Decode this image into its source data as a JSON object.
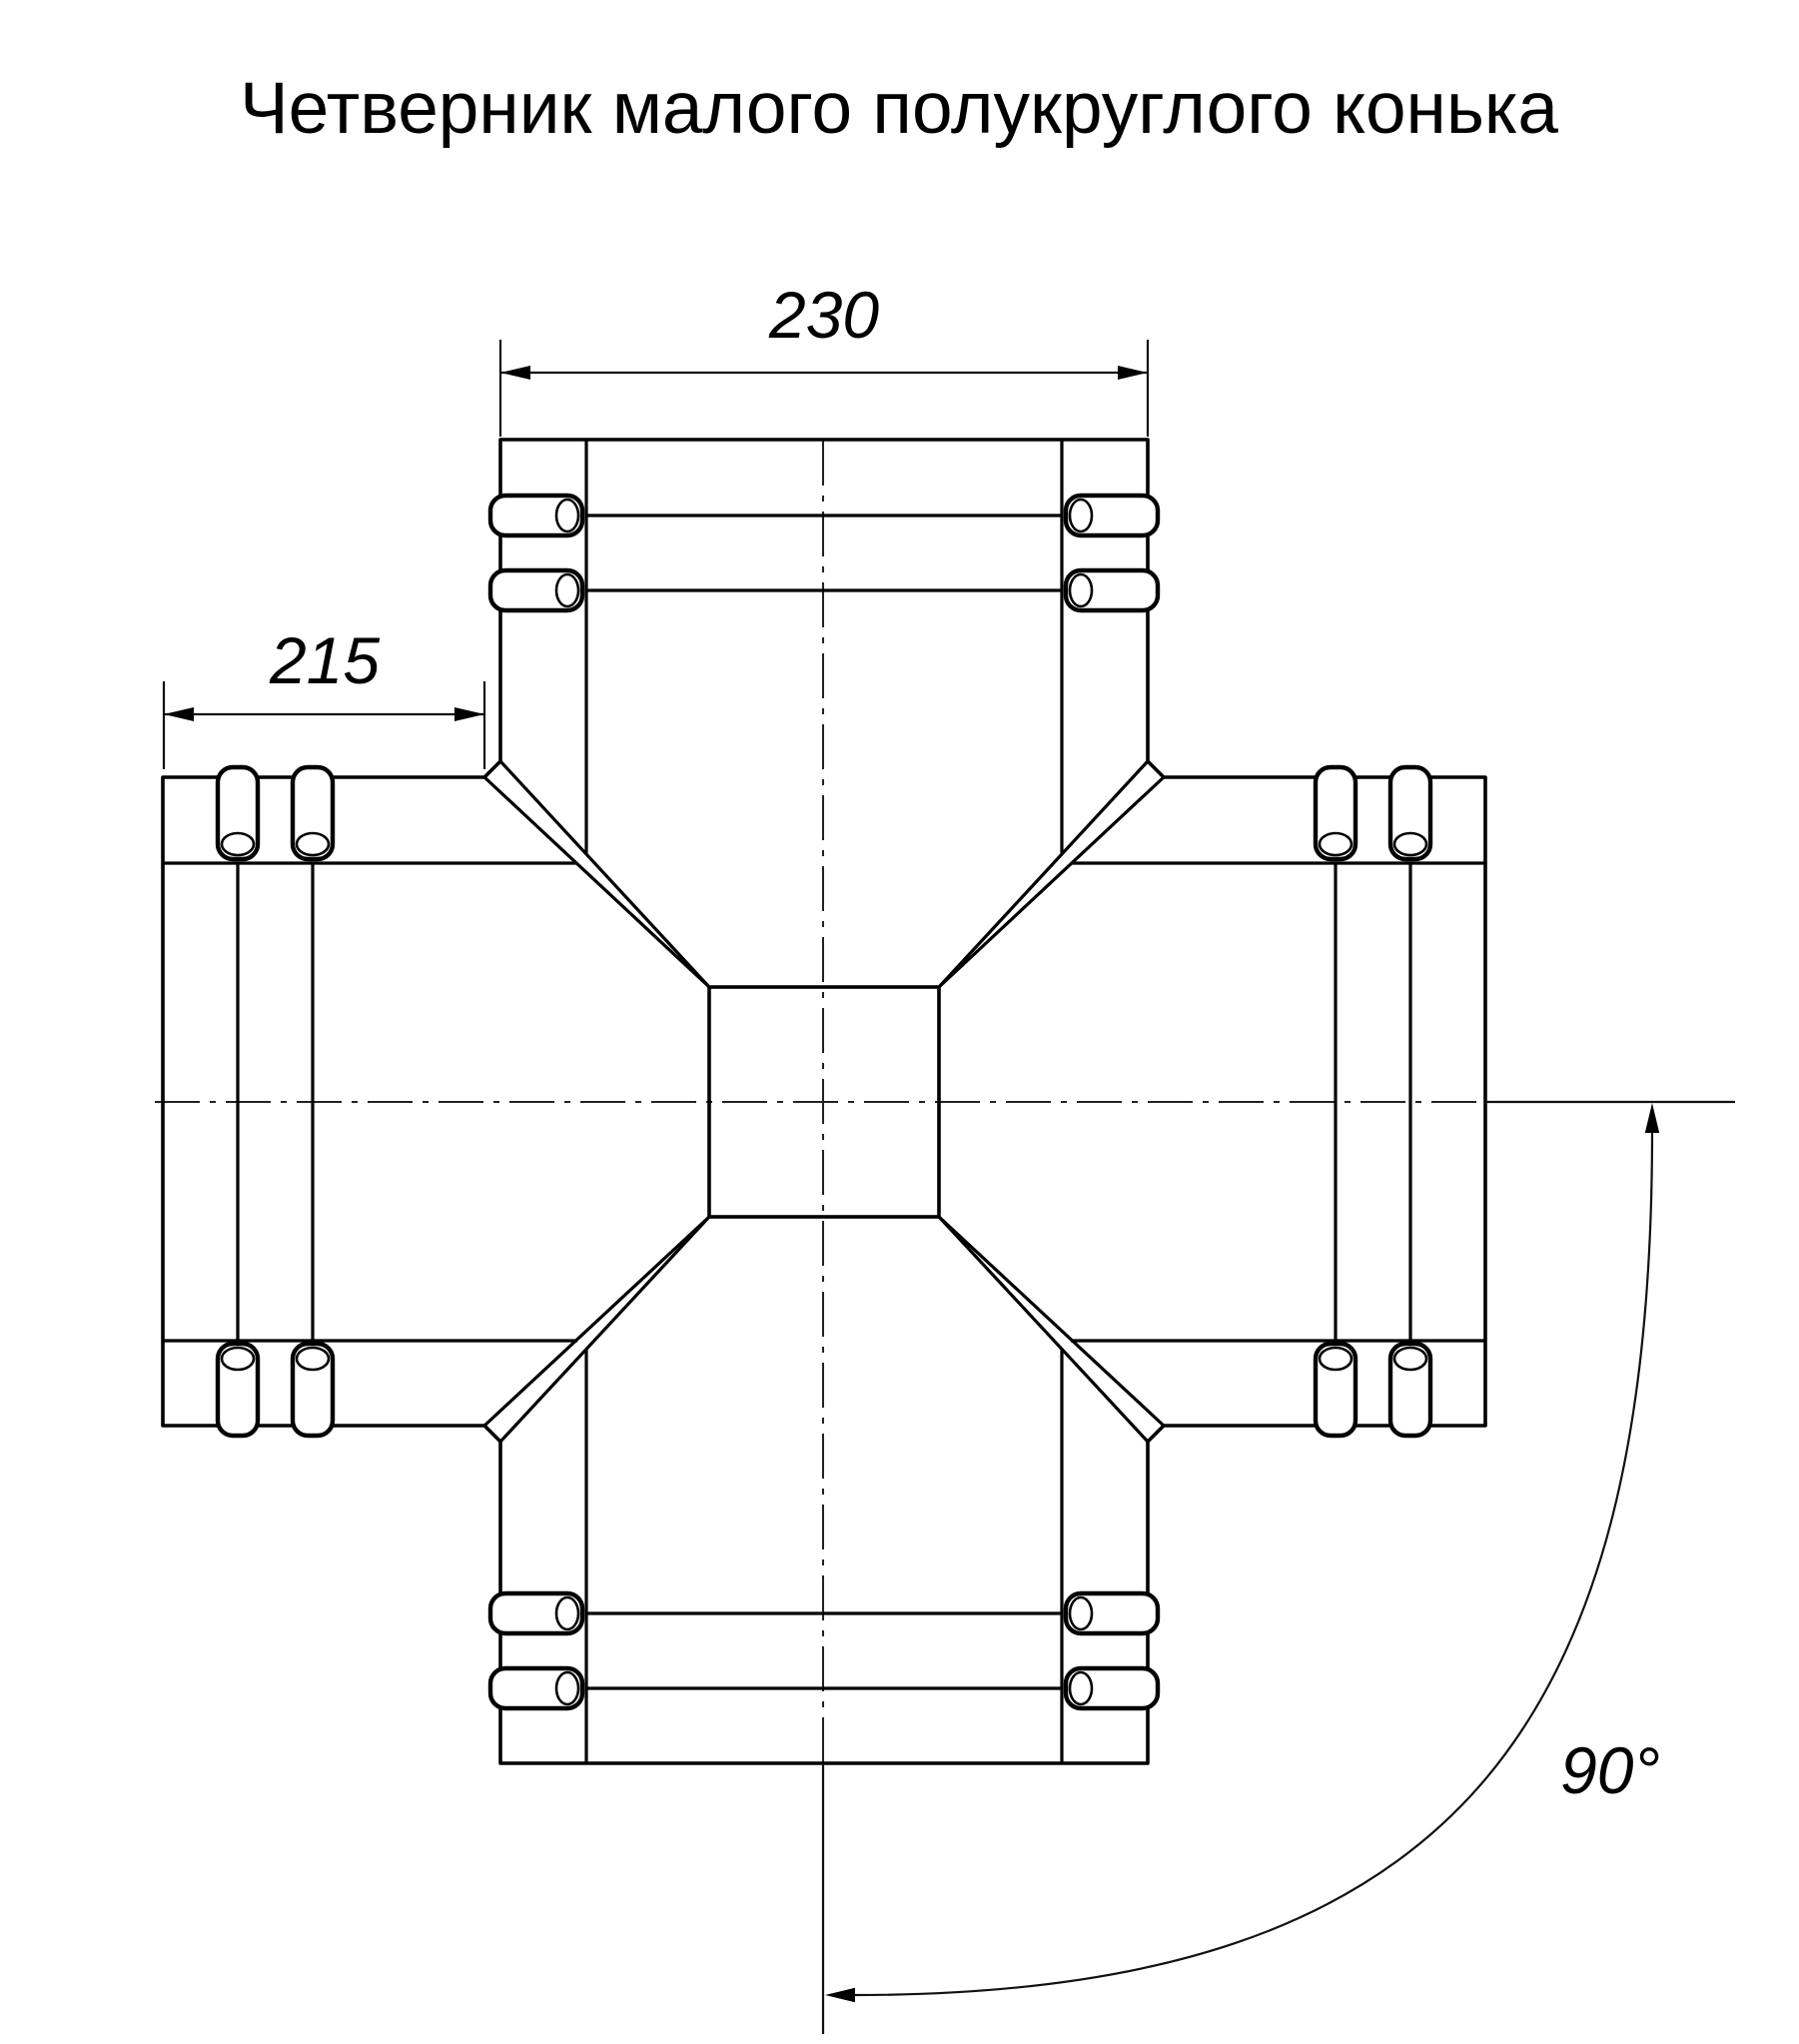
{
  "title": "Четверник малого полукруглого конька",
  "dimensions": {
    "top_width": "230",
    "left_length": "215",
    "angle": "90°"
  },
  "colors": {
    "line": "#000000",
    "background": "#ffffff"
  }
}
